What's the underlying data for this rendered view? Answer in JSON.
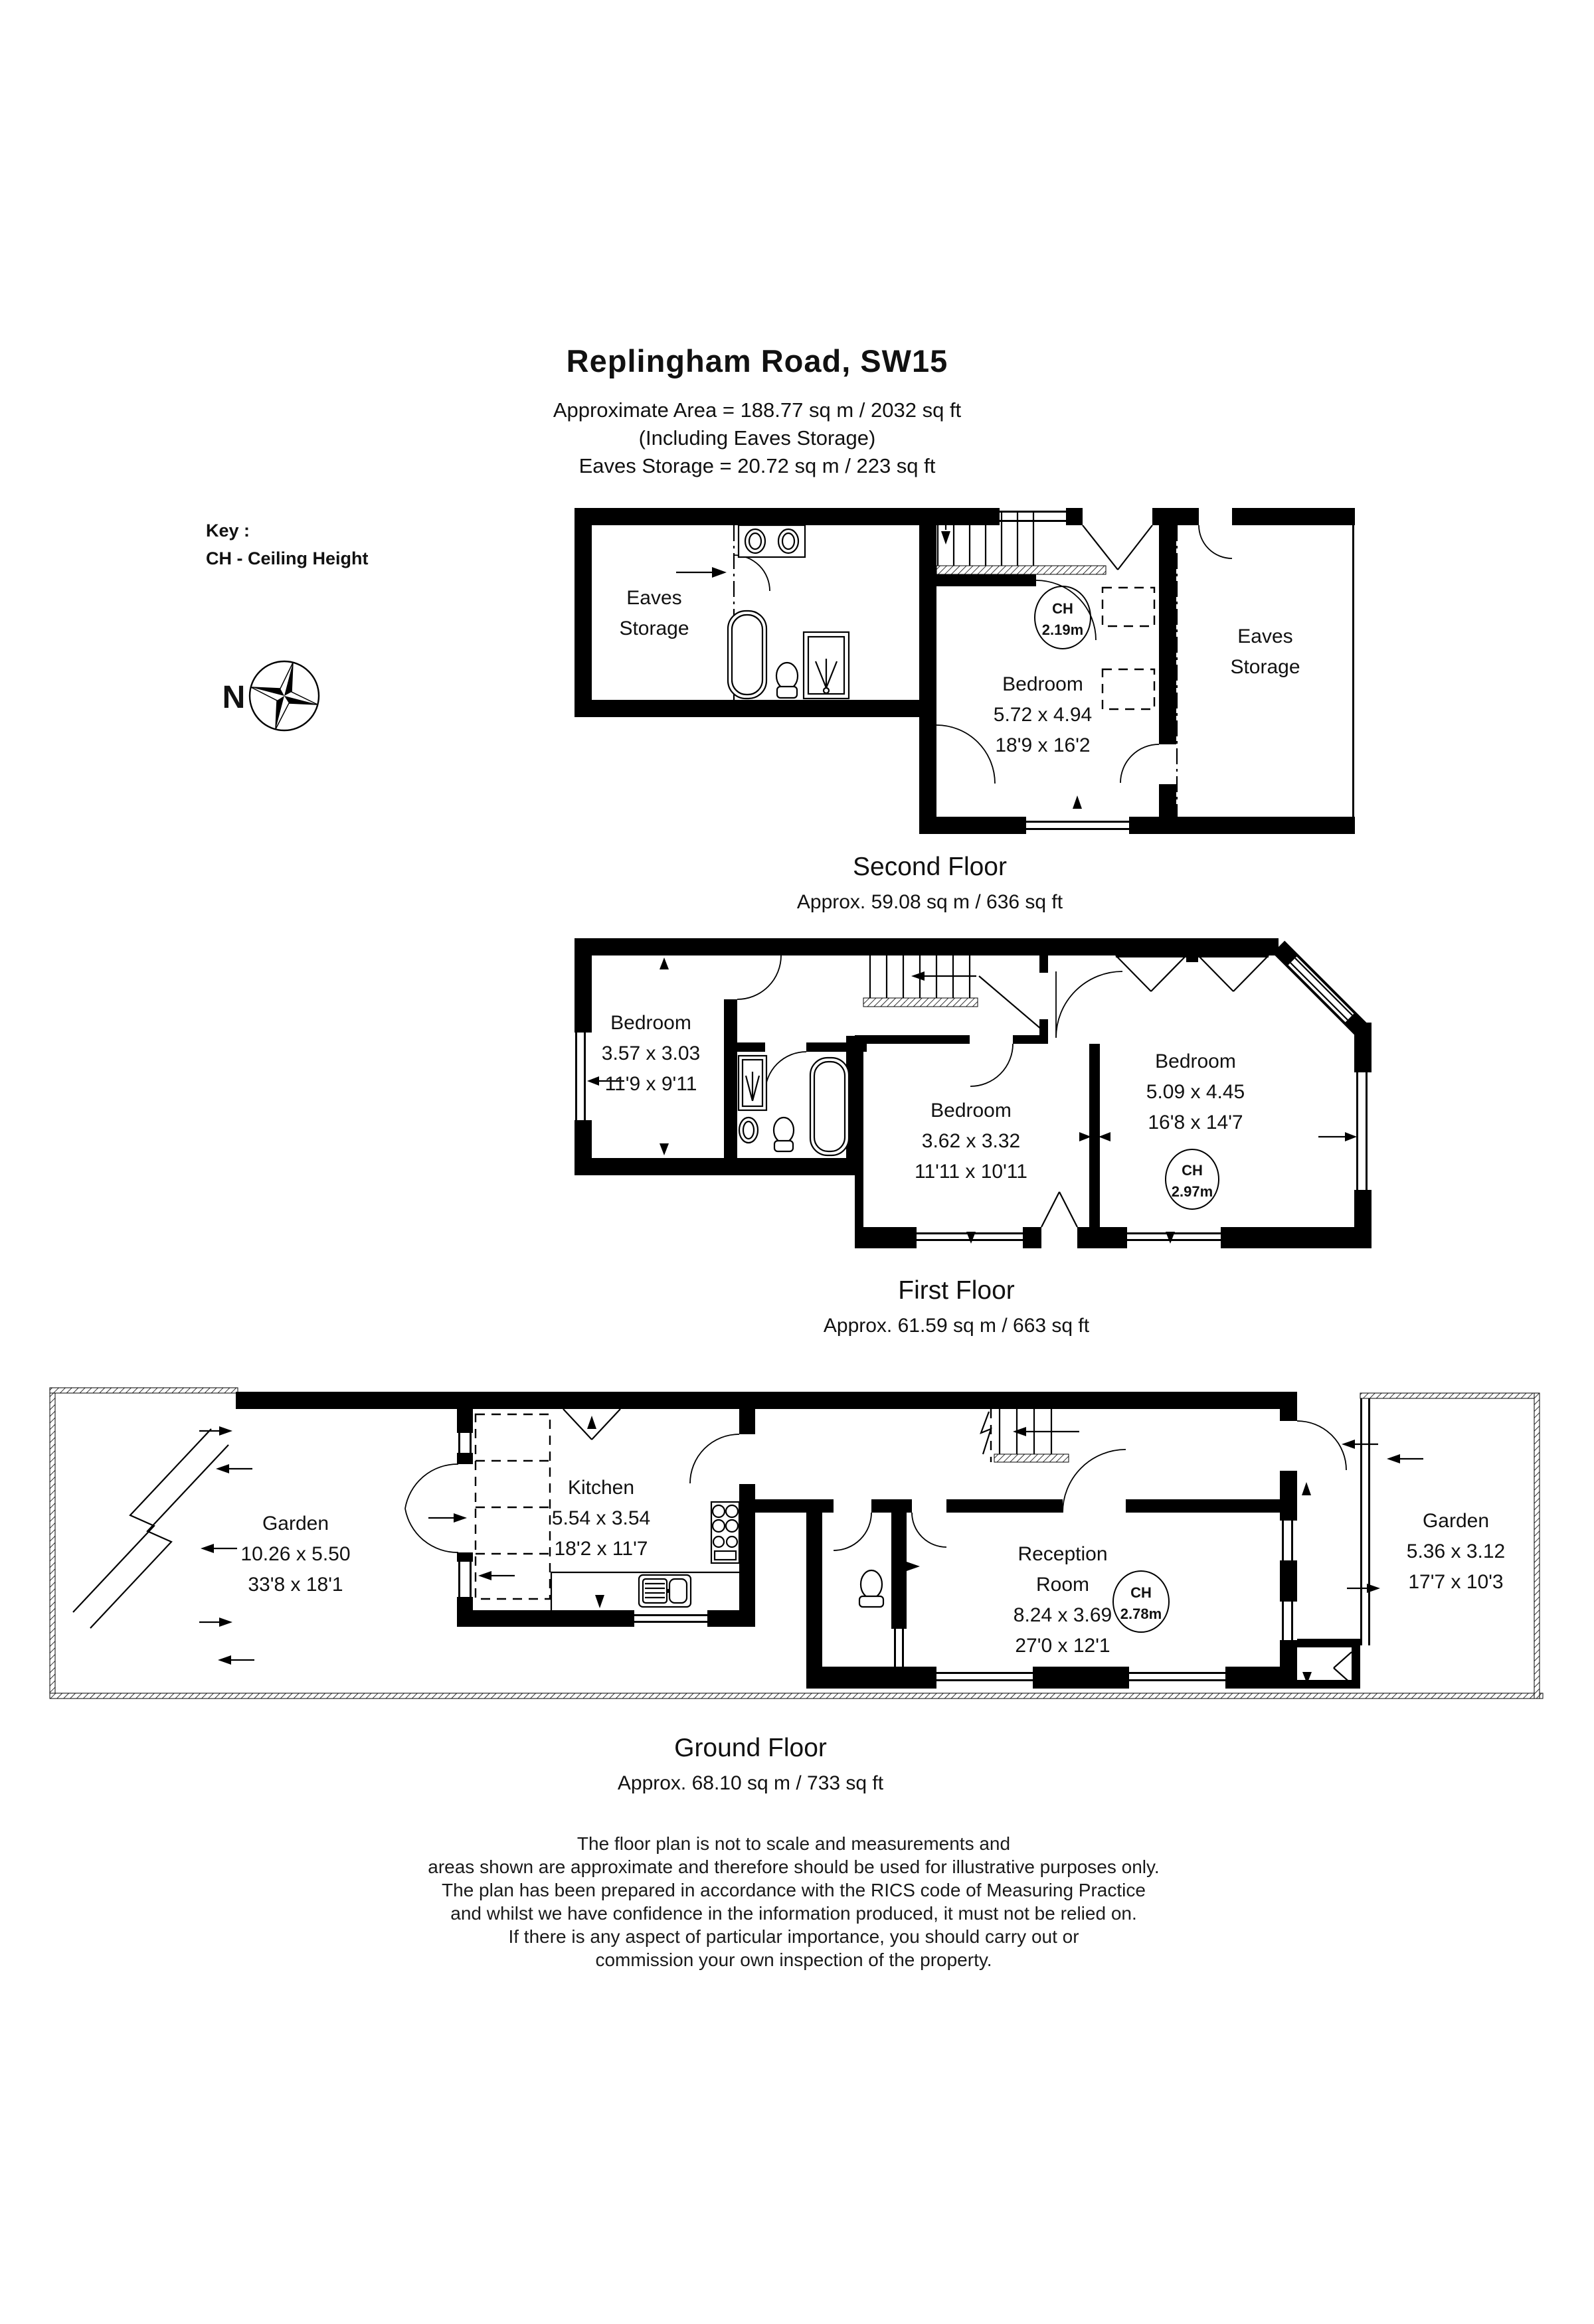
{
  "title": {
    "address": "Replingham Road, SW15",
    "area_line": "Approximate Area =  188.77 sq m / 2032 sq ft",
    "including_line": "(Including Eaves Storage)",
    "eaves_line": "Eaves Storage =  20.72 sq m / 223 sq ft"
  },
  "key": {
    "label": "Key :",
    "ch_definition": "CH - Ceiling Height",
    "north": "N"
  },
  "floors": {
    "second": {
      "label": "Second Floor",
      "area": "Approx. 59.08 sq m / 636 sq ft",
      "eaves_left": {
        "line1": "Eaves",
        "line2": "Storage"
      },
      "eaves_right": {
        "line1": "Eaves",
        "line2": "Storage"
      },
      "bedroom": {
        "name": "Bedroom",
        "metric": "5.72 x 4.94",
        "imperial": "18'9 x 16'2",
        "ch_label": "CH",
        "ch_value": "2.19m"
      }
    },
    "first": {
      "label": "First Floor",
      "area": "Approx. 61.59 sq m / 663 sq ft",
      "bedroom_left": {
        "name": "Bedroom",
        "metric": "3.57 x 3.03",
        "imperial": "11'9 x 9'11"
      },
      "bedroom_middle": {
        "name": "Bedroom",
        "metric": "3.62 x 3.32",
        "imperial": "11'11 x 10'11"
      },
      "bedroom_right": {
        "name": "Bedroom",
        "metric": "5.09 x 4.45",
        "imperial": "16'8 x 14'7",
        "ch_label": "CH",
        "ch_value": "2.97m"
      }
    },
    "ground": {
      "label": "Ground Floor",
      "area": "Approx. 68.10 sq m / 733 sq ft",
      "garden_left": {
        "name": "Garden",
        "metric": "10.26 x 5.50",
        "imperial": "33'8 x 18'1"
      },
      "kitchen": {
        "name": "Kitchen",
        "metric": "5.54 x 3.54",
        "imperial": "18'2 x 11'7"
      },
      "reception": {
        "name_line1": "Reception",
        "name_line2": "Room",
        "metric": "8.24 x 3.69",
        "imperial": "27'0 x 12'1",
        "ch_label": "CH",
        "ch_value": "2.78m"
      },
      "garden_right": {
        "name": "Garden",
        "metric": "5.36 x 3.12",
        "imperial": "17'7 x 10'3"
      }
    }
  },
  "disclaimer": [
    "The floor plan is not to scale and measurements and",
    "areas shown are approximate and therefore should be used for illustrative purposes only.",
    "The plan has been prepared in accordance with the RICS code of Measuring Practice",
    "and whilst we have confidence in the information produced, it must not be relied on.",
    "If there is any aspect of particular importance, you should carry out or",
    "commission your own inspection of the property."
  ]
}
